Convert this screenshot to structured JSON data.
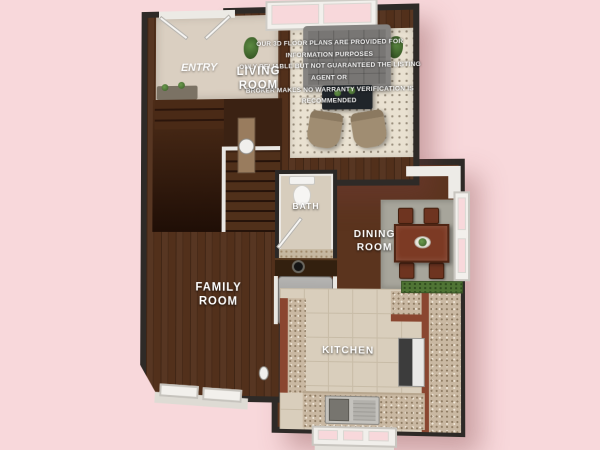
{
  "scene": {
    "type": "3d-floor-plan-render",
    "floor": "first-floor"
  },
  "disclaimer": {
    "line1": "OUR 3D FLOOR PLANS ARE PROVIDED FOR INFORMATION PURPOSES",
    "line2": "ONLY RELIABLE BUT NOT GUARANTEED THE LISTING AGENT OR",
    "line3": "BROKER MAKES NO WARRANTY VERIFICATION IS RECOMMENDED"
  },
  "rooms": {
    "entry": {
      "label": "ENTRY"
    },
    "living": {
      "line1": "LIVING",
      "line2": "ROOM"
    },
    "bath": {
      "label": "BATH"
    },
    "dining": {
      "line1": "DINING",
      "line2": "ROOM"
    },
    "family": {
      "line1": "FAMILY",
      "line2": "ROOM"
    },
    "kitchen": {
      "label": "KITCHEN"
    }
  },
  "palette": {
    "background_pink": "#f8d8db",
    "wall_dark": "#2e2a27",
    "wood_floor": "#52301b",
    "living_rug": "#e9e1d1",
    "dining_rug": "#a7a59b",
    "kitchen_tile": "#d9cebc",
    "cabinet_red": "#8a4630",
    "granite": "#c9b8a2",
    "dining_table": "#7c3a24",
    "sofa_gray": "#787674",
    "armchair_tan": "#a08d72",
    "stairs_brown": "#3b2213",
    "plant_green": "#4c7238",
    "trim_white": "#f2f0ec"
  }
}
